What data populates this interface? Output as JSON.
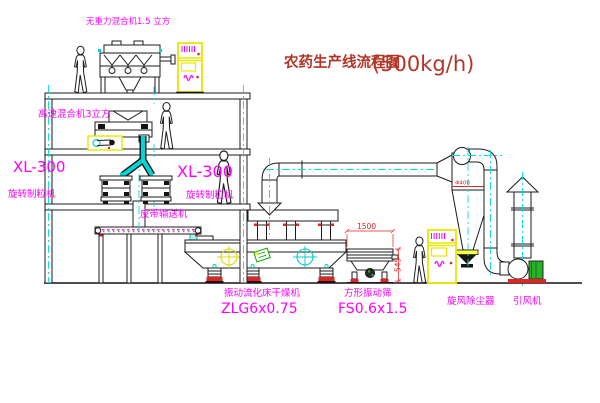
{
  "title": {
    "text": "农药生产线流程图",
    "capacity": "(500kg/h)"
  },
  "labels": {
    "gravity_free_mixer": "无重力混合机1.5 立方",
    "high_speed_mixer": "高速混合机3立方",
    "granulator_left_model": "XL-300",
    "granulator_left_name": "旋转制粒机",
    "granulator_mid_model": "XL-300",
    "granulator_mid_name": "旋转制粒机",
    "belt_conveyor": "皮带输送机",
    "fluid_bed_dryer": "振动流化床干燥机",
    "fluid_bed_dryer_model": "ZLG6x0.75",
    "vibrating_sieve": "方形振动筛",
    "vibrating_sieve_model": "FS0.6x1.5",
    "cyclone": "旋风除尘器",
    "induced_draft_fan": "引风机"
  },
  "dimensions": {
    "sieve_length": "1500",
    "sieve_height": "545",
    "cyclone_dia": "Φ400"
  },
  "colors": {
    "label_magenta": "#ff00ff",
    "title_red": "#b23527",
    "dim_red": "#e32222",
    "centerline_cyan": "#00dede",
    "cabinet_yellow": "#e8e800",
    "motor_green": "#2ab12a"
  }
}
